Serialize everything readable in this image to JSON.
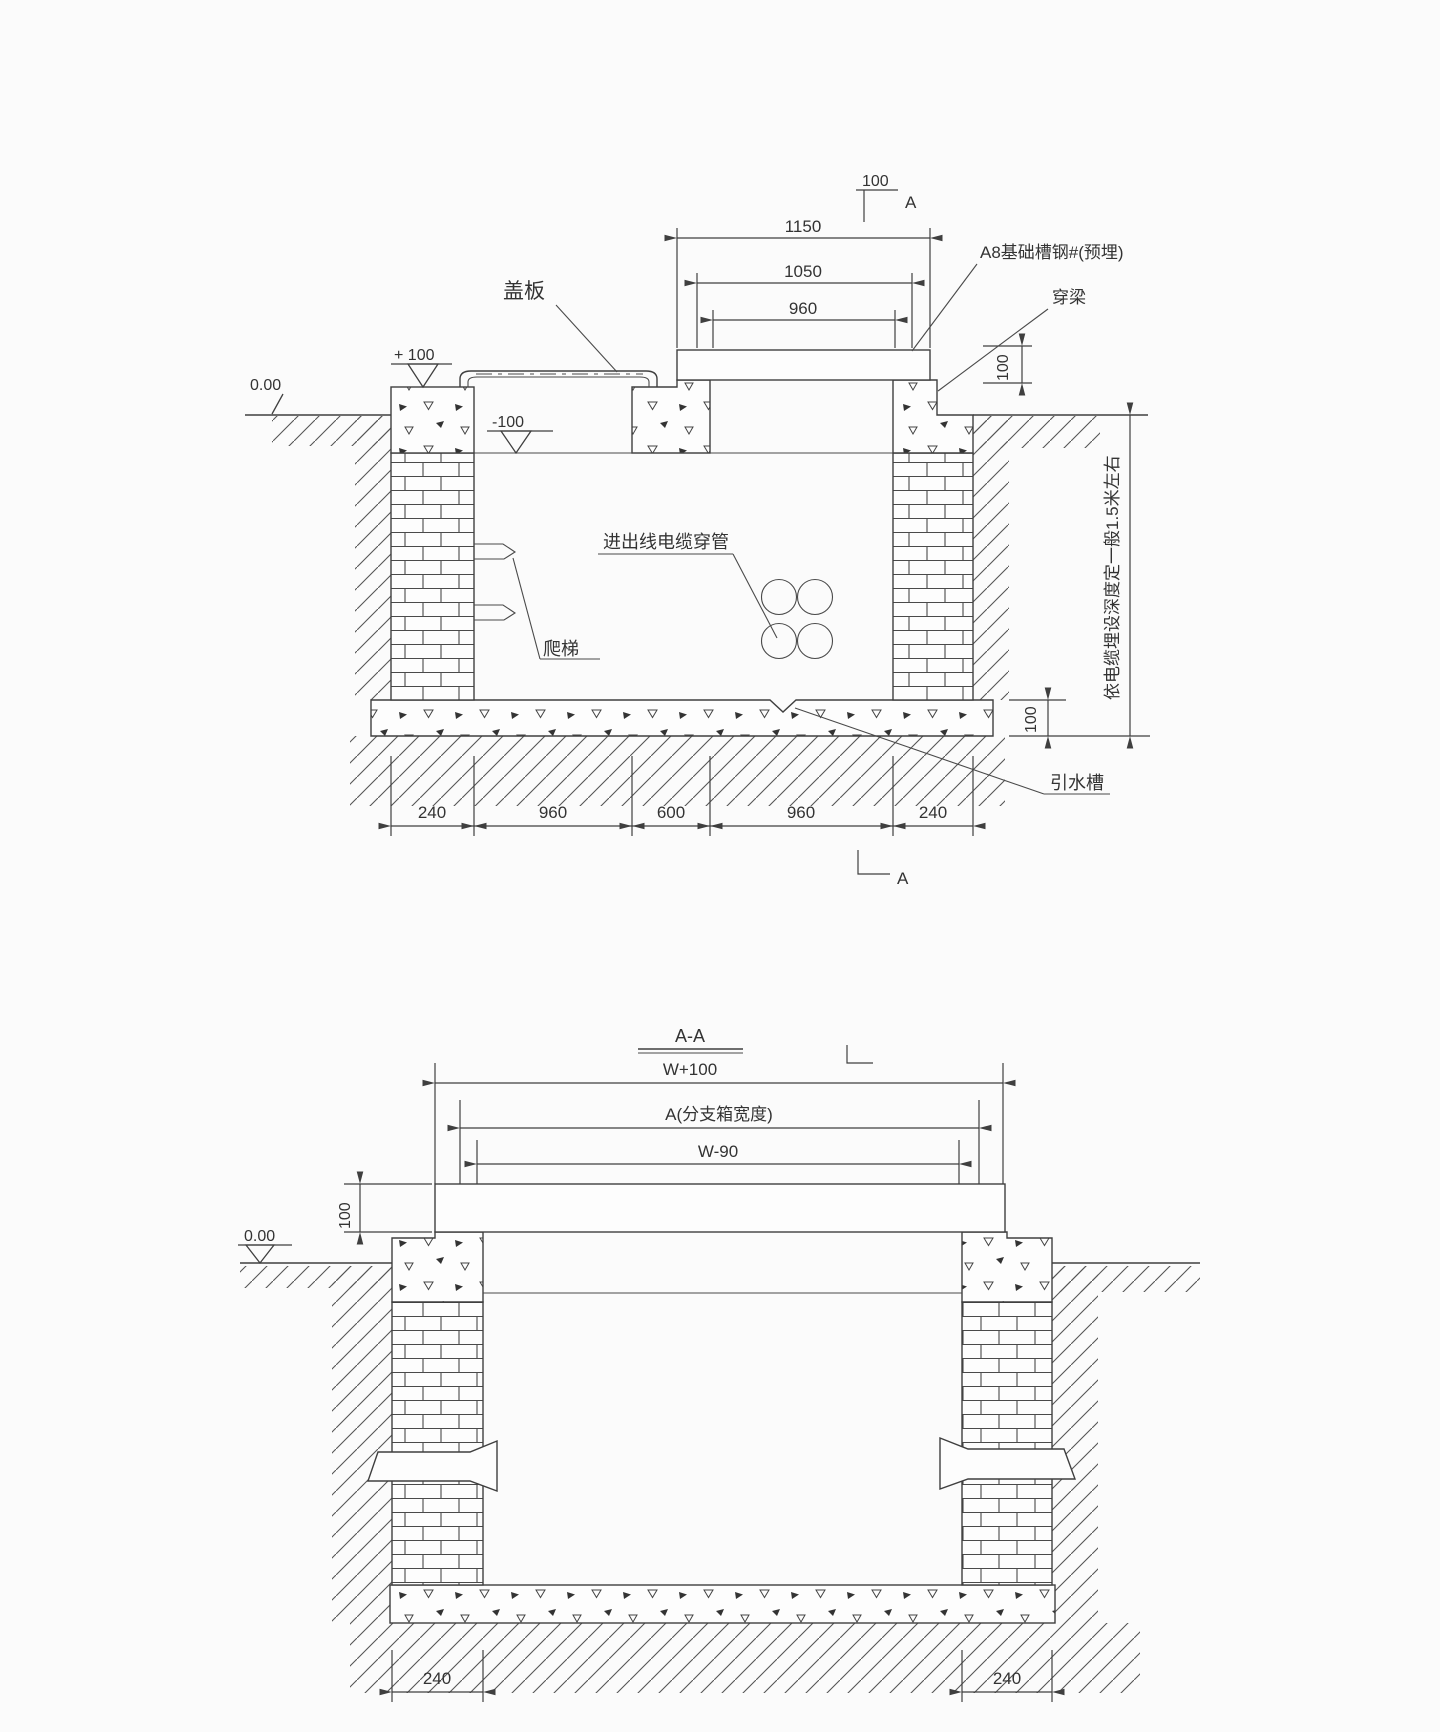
{
  "drawing1": {
    "labels": {
      "cover_plate": "盖板",
      "channel_steel": "A8基础槽钢#(预埋)",
      "through_beam": "穿梁",
      "cable_conduit": "进出线电缆穿管",
      "ladder": "爬梯",
      "drain_channel": "引水槽",
      "depth_note": "依电缆埋设深度定一般1.5米左右"
    },
    "levels": {
      "ground": "0.00",
      "plus100": "+ 100",
      "minus100": "-100"
    },
    "dims": {
      "top": [
        "1150",
        "1050",
        "960"
      ],
      "slab_thickness": "100",
      "section_offset": "100",
      "floor_thickness": "100",
      "bottom": [
        "240",
        "960",
        "600",
        "960",
        "240"
      ]
    },
    "section_mark_top": "A",
    "section_mark_bottom": "A"
  },
  "drawing2": {
    "title": "A-A",
    "dims": {
      "w_plus": "W+100",
      "a_width": "A(分支箱宽度)",
      "w_minus": "W-90",
      "slab_thickness": "100",
      "bottom_left": "240",
      "bottom_right": "240"
    },
    "levels": {
      "ground": "0.00"
    }
  }
}
